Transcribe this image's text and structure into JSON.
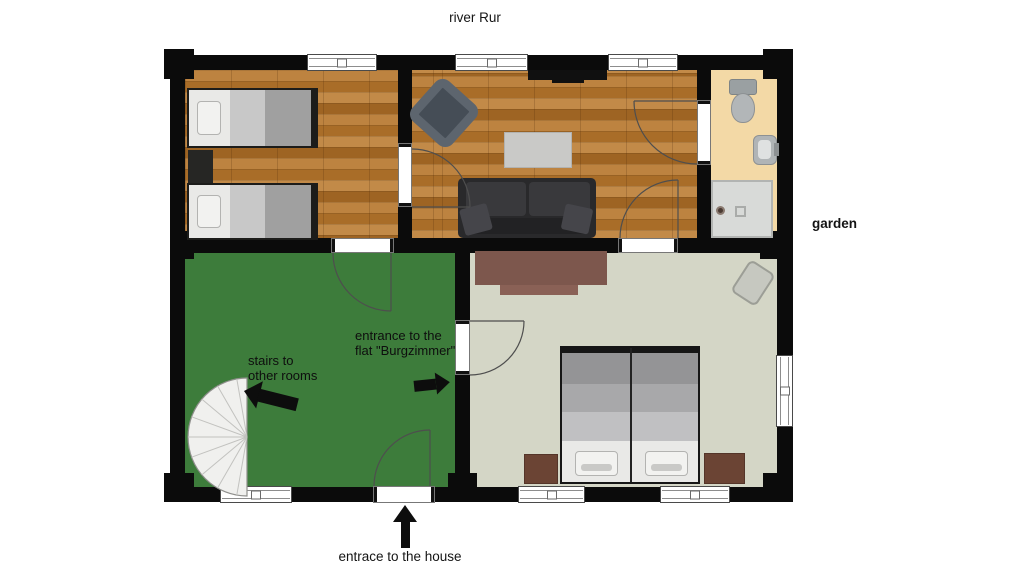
{
  "annotations": {
    "river": "river Rur",
    "garden": "garden",
    "house_entrance": "entrace to the house",
    "stairs": {
      "line1": "stairs to",
      "line2": "other rooms"
    },
    "flat_entrance": {
      "line1": "entrance to the",
      "line2": "flat \"Burgzimmer\""
    }
  },
  "colors": {
    "wall": "#0b0b0b",
    "wood_floor": "#b0762f",
    "hall_floor": "#3d7c3b",
    "burgzimmer_floor": "#d4d6c6",
    "bathroom_floor": "#f3d9a6",
    "stairs": "#f0f0ee",
    "arrow": "#0d0d0d",
    "wardrobe_brown": "#7d574d",
    "nightstand_brown": "#6b4434"
  }
}
